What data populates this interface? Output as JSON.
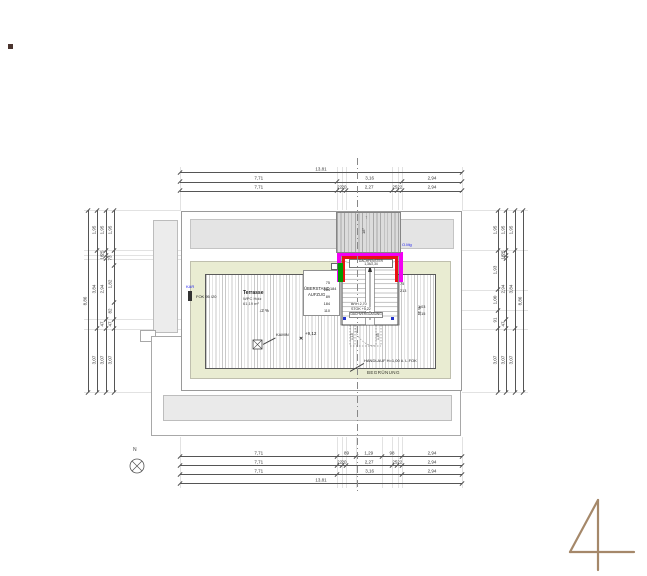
{
  "drawing": {
    "sheet_number": "4",
    "north_label": "N",
    "terrace": {
      "title": "Terrasse",
      "material": "WPC Holz",
      "area": "61,19 m²",
      "slope_left": "↓2 %",
      "slope_right": "↓2 %",
      "level": "+9,12",
      "level_marker": "✕",
      "kamin": "KAMIN",
      "handrail": "HANDLAUF H=1,00 ü. L.FOK",
      "greening": "BEGRÜNUNG"
    },
    "elevator_box": {
      "line1": "ÜBERSTAND",
      "dim": "184",
      "line2": "AUFZUG"
    },
    "roof": {
      "slope": "18°",
      "slope_arrow": "↑"
    },
    "stair": {
      "window": "DACHFENSTER",
      "window_size": "1,34/2,34",
      "brh": "BRH 2,70",
      "stok": "STOK +5,22",
      "glazing": "DACHVERGLASUNG",
      "left_dims": [
        "75",
        "184",
        "89",
        "184",
        "110"
      ],
      "right_dims": [
        "75",
        "213"
      ],
      "far_right_dims": [
        "1,03",
        "2,15"
      ],
      "below_dims": [
        "1,10",
        "1,05"
      ]
    },
    "annotations": {
      "kar": "KAR",
      "fok": "FOK 95 /20",
      "omg": "O.Mg"
    }
  },
  "dimensions": {
    "top_rows": [
      [
        "13,81"
      ],
      [
        "7,71",
        "3,16",
        "2,94"
      ],
      [
        "7,71",
        "22",
        "20",
        "2,27",
        "25",
        "22",
        "2,94"
      ]
    ],
    "bottom_rows": [
      [
        "7,71",
        "89",
        "1,29",
        "98",
        "2,94"
      ],
      [
        "7,71",
        "22",
        "20",
        "2,27",
        "25",
        "22",
        "2,94"
      ],
      [
        "7,71",
        "3,16",
        "2,94"
      ],
      [
        "13,81"
      ]
    ],
    "left_cols": [
      [
        "8,86"
      ],
      [
        "1,95",
        "3,84",
        "3,07"
      ],
      [
        "1,95",
        "25",
        "18",
        "2,94",
        "47",
        "3,07"
      ],
      [
        "1,95",
        "73",
        "1,82",
        "82",
        "47",
        "3,07"
      ]
    ],
    "right_cols": [
      [
        "1,95",
        "1,93",
        "1,00",
        "91",
        "3,07"
      ],
      [
        "1,95",
        "25",
        "18",
        "2,94",
        "47",
        "3,07"
      ],
      [
        "1,95",
        "3,84",
        "3,07"
      ],
      [
        "8,86"
      ]
    ],
    "accent_colors": {
      "magenta": "#f300f3",
      "red": "#e81111",
      "green": "#009a00",
      "logo_tan": "#a5886a"
    }
  }
}
